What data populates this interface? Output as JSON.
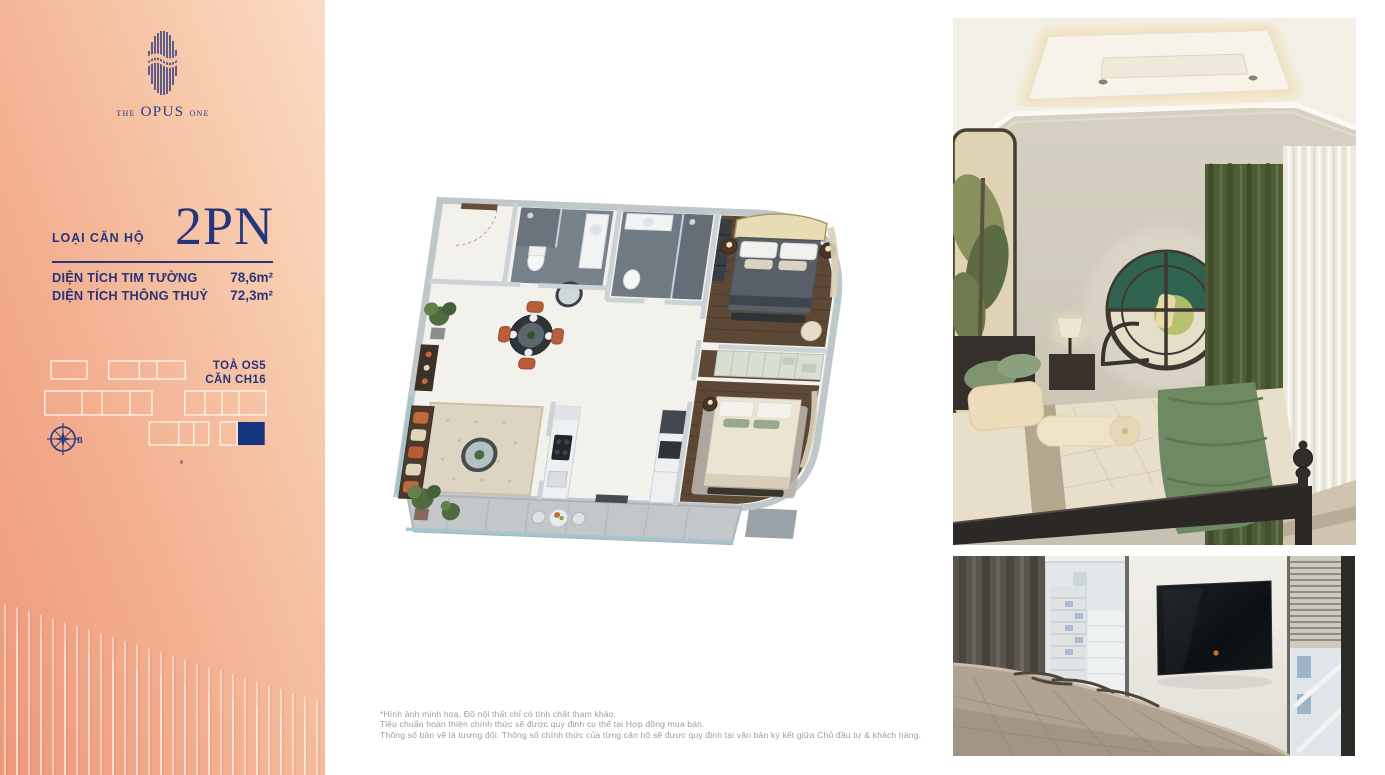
{
  "logo": {
    "the": "THE",
    "opus": "OPUS",
    "one": "ONE"
  },
  "unit": {
    "type_label": "LOẠI CĂN HỘ",
    "type_value": "2PN"
  },
  "specs": [
    {
      "label": "DIỆN TÍCH TIM TƯỜNG",
      "value": "78,6m²"
    },
    {
      "label": "DIỆN TÍCH THÔNG THUỶ",
      "value": "72,3m²"
    }
  ],
  "location": {
    "tower_label": "TOÀ",
    "tower_value": "OS5",
    "unit_label": "CĂN",
    "unit_value": "CH16",
    "compass_label": "B"
  },
  "disclaimer": [
    "*Hình ảnh minh hoạ. Đồ nội thất chỉ có tính chất tham khảo.",
    "Tiêu chuẩn hoàn thiện chính thức sẽ được quy định cụ thể tại Hợp đồng mua bán.",
    "Thông số bản vẽ là tương đối. Thông số chính thức của từng căn hộ sẽ được quy định tại văn bản ký kết giữa Chủ đầu tư & khách hàng."
  ],
  "colors": {
    "navy": "#273678",
    "navy_fill": "#16337E",
    "salmon": "#EF987A",
    "peach": "#FADCC4"
  }
}
